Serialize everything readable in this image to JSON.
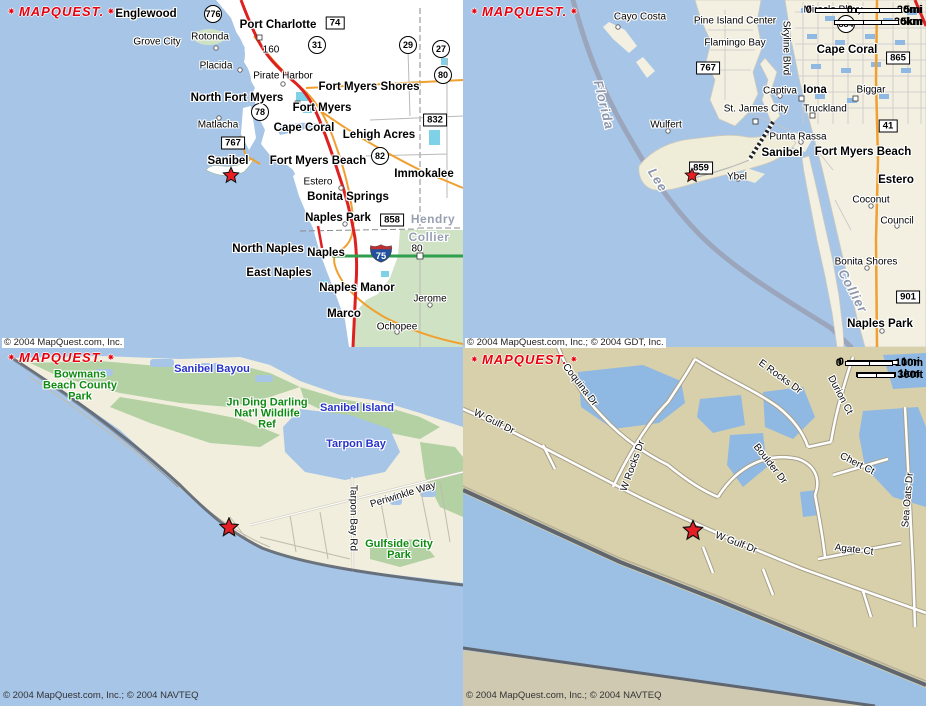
{
  "logo": {
    "text": "MAPQUEST."
  },
  "copyrights": {
    "mid_left": "© 2004 MapQuest.com, Inc.",
    "mid_right": "© 2004 MapQuest.com, Inc.; © 2004 GDT, Inc.",
    "bottom_left": "© 2004 MapQuest.com, Inc.; © 2004 NAVTEQ",
    "bottom_right": "© 2004 MapQuest.com, Inc.; © 2004 NAVTEQ"
  },
  "colors": {
    "water": "#a7c5e7",
    "land_white": "#ffffff",
    "land_cream": "#f3f0e2",
    "land_pale": "#f1eedd",
    "land_tan": "#d7d0ab",
    "land_tan_muted": "#cfc9b2",
    "park_green": "#b3d1a2",
    "park_light": "#cfe2c4",
    "lake_cyan": "#7fd1e8",
    "canal_blue": "#8fb8e2",
    "road_red": "#dd2020",
    "road_orange": "#f0a030",
    "road_green": "#2f9e4f",
    "road_gray": "#b9b9b9",
    "boundary_gray": "#99a0b4",
    "shore_dark": "#5f6670",
    "star_red": "#e81e25",
    "logo_red": "#e8000c",
    "label_water_blue": "#2733cc",
    "label_park_green": "#0e8a10",
    "label_county_gray": "#98a0b0"
  },
  "maps": [
    {
      "name": "regional-overview",
      "scale": {
        "zero": "0",
        "primary": "20mi",
        "secondary": "20km"
      },
      "labels": [
        {
          "type": "city",
          "text": "Englewood",
          "x": 146,
          "y": 14
        },
        {
          "type": "city",
          "text": "Port Charlotte",
          "x": 278,
          "y": 25
        },
        {
          "type": "city",
          "text": "Fort Myers Shores",
          "x": 369,
          "y": 87
        },
        {
          "type": "city",
          "text": "North Fort Myers",
          "x": 237,
          "y": 98
        },
        {
          "type": "city",
          "text": "Fort Myers",
          "x": 322,
          "y": 108
        },
        {
          "type": "city",
          "text": "Cape Coral",
          "x": 304,
          "y": 128
        },
        {
          "type": "city",
          "text": "Lehigh Acres",
          "x": 379,
          "y": 135
        },
        {
          "type": "city",
          "text": "Sanibel",
          "x": 228,
          "y": 161
        },
        {
          "type": "city",
          "text": "Fort Myers Beach",
          "x": 318,
          "y": 161
        },
        {
          "type": "city",
          "text": "Immokalee",
          "x": 424,
          "y": 174
        },
        {
          "type": "city",
          "text": "Bonita Springs",
          "x": 348,
          "y": 197
        },
        {
          "type": "city",
          "text": "Naples Park",
          "x": 338,
          "y": 218
        },
        {
          "type": "city",
          "text": "North Naples",
          "x": 268,
          "y": 249
        },
        {
          "type": "city",
          "text": "Naples",
          "x": 326,
          "y": 253
        },
        {
          "type": "city",
          "text": "East Naples",
          "x": 279,
          "y": 273
        },
        {
          "type": "city",
          "text": "Naples Manor",
          "x": 357,
          "y": 288
        },
        {
          "type": "city",
          "text": "Marco",
          "x": 344,
          "y": 314
        },
        {
          "type": "town",
          "text": "Grove City",
          "x": 157,
          "y": 42
        },
        {
          "type": "town",
          "text": "Rotonda",
          "x": 210,
          "y": 37
        },
        {
          "type": "town",
          "text": "Placida",
          "x": 216,
          "y": 66
        },
        {
          "type": "town",
          "text": "Pirate Harbor",
          "x": 283,
          "y": 76
        },
        {
          "type": "town",
          "text": "Matlacha",
          "x": 218,
          "y": 125
        },
        {
          "type": "town",
          "text": "Estero",
          "x": 318,
          "y": 182
        },
        {
          "type": "town",
          "text": "Jerome",
          "x": 430,
          "y": 299
        },
        {
          "type": "town",
          "text": "Ochopee",
          "x": 397,
          "y": 327
        },
        {
          "type": "num",
          "text": "160",
          "x": 271,
          "y": 50
        },
        {
          "type": "num",
          "text": "80",
          "x": 417,
          "y": 249
        },
        {
          "type": "county",
          "text": "Hendry",
          "x": 433,
          "y": 219
        },
        {
          "type": "county",
          "text": "Collier",
          "x": 429,
          "y": 237
        }
      ],
      "shields": [
        {
          "shape": "circle",
          "text": "776",
          "x": 213,
          "y": 14
        },
        {
          "shape": "box",
          "text": "74",
          "x": 335,
          "y": 23
        },
        {
          "shape": "circle",
          "text": "31",
          "x": 317,
          "y": 45
        },
        {
          "shape": "circle",
          "text": "29",
          "x": 408,
          "y": 45
        },
        {
          "shape": "circle",
          "text": "27",
          "x": 441,
          "y": 49
        },
        {
          "shape": "circle",
          "text": "80",
          "x": 443,
          "y": 75
        },
        {
          "shape": "circle",
          "text": "78",
          "x": 260,
          "y": 112
        },
        {
          "shape": "box",
          "text": "832",
          "x": 435,
          "y": 120
        },
        {
          "shape": "box",
          "text": "767",
          "x": 233,
          "y": 143
        },
        {
          "shape": "circle",
          "text": "82",
          "x": 380,
          "y": 156
        },
        {
          "shape": "box",
          "text": "858",
          "x": 392,
          "y": 220
        },
        {
          "shape": "interstate",
          "text": "75",
          "x": 381,
          "y": 256
        }
      ],
      "star": {
        "x": 231,
        "y": 175,
        "size": 17
      }
    },
    {
      "name": "islands-area",
      "scale": {
        "zero": "0",
        "primary": "5mi",
        "secondary": "5km"
      },
      "labels": [
        {
          "type": "city",
          "text": "Cape Coral",
          "x": 847,
          "y": 50
        },
        {
          "type": "city",
          "text": "Iona",
          "x": 815,
          "y": 90
        },
        {
          "type": "city",
          "text": "Sanibel",
          "x": 782,
          "y": 153
        },
        {
          "type": "city",
          "text": "Fort Myers Beach",
          "x": 863,
          "y": 152
        },
        {
          "type": "city",
          "text": "Estero",
          "x": 896,
          "y": 180
        },
        {
          "type": "city",
          "text": "Naples Park",
          "x": 880,
          "y": 324
        },
        {
          "type": "town",
          "text": "Cayo Costa",
          "x": 640,
          "y": 17
        },
        {
          "type": "town",
          "text": "Pine Island Center",
          "x": 735,
          "y": 21
        },
        {
          "type": "town",
          "text": "Flamingo Bay",
          "x": 735,
          "y": 43
        },
        {
          "type": "town",
          "text": "Miracle Pkwy",
          "x": 833,
          "y": 10
        },
        {
          "type": "town",
          "text": "Captiva",
          "x": 780,
          "y": 91
        },
        {
          "type": "town",
          "text": "Wulfert",
          "x": 666,
          "y": 125
        },
        {
          "type": "town",
          "text": "St. James City",
          "x": 756,
          "y": 109
        },
        {
          "type": "town",
          "text": "Truckland",
          "x": 825,
          "y": 109
        },
        {
          "type": "town",
          "text": "Biggar",
          "x": 871,
          "y": 90
        },
        {
          "type": "town",
          "text": "Punta Rassa",
          "x": 798,
          "y": 137
        },
        {
          "type": "town",
          "text": "Ybel",
          "x": 737,
          "y": 177
        },
        {
          "type": "town",
          "text": "Coconut",
          "x": 871,
          "y": 200
        },
        {
          "type": "town",
          "text": "Council",
          "x": 897,
          "y": 221
        },
        {
          "type": "town",
          "text": "Bonita Shores",
          "x": 866,
          "y": 262
        },
        {
          "type": "state",
          "text": "Florida",
          "x": 604,
          "y": 105,
          "rot": 76
        },
        {
          "type": "state",
          "text": "Lee",
          "x": 658,
          "y": 180,
          "rot": 58
        },
        {
          "type": "state",
          "text": "Collier",
          "x": 853,
          "y": 291,
          "rot": 62
        },
        {
          "type": "street",
          "text": "Skyline Blvd",
          "x": 786,
          "y": 48,
          "rot": 90
        }
      ],
      "shields": [
        {
          "shape": "box",
          "text": "767",
          "x": 708,
          "y": 68
        },
        {
          "shape": "circle",
          "text": "884",
          "x": 846,
          "y": 24
        },
        {
          "shape": "box",
          "text": "865",
          "x": 898,
          "y": 58
        },
        {
          "shape": "box",
          "text": "41",
          "x": 888,
          "y": 126
        },
        {
          "shape": "box",
          "text": "859",
          "x": 701,
          "y": 168
        },
        {
          "shape": "box",
          "text": "901",
          "x": 908,
          "y": 297
        }
      ],
      "star": {
        "x": 692,
        "y": 175,
        "size": 15
      }
    },
    {
      "name": "sanibel-island",
      "scale": {
        "zero": "0",
        "primary": "1mi",
        "secondary": "1km"
      },
      "labels": [
        {
          "type": "water",
          "text": "Sanibel Bayou",
          "x": 212,
          "y": 369
        },
        {
          "type": "water",
          "text": "Sanibel Island",
          "x": 357,
          "y": 408
        },
        {
          "type": "water",
          "text": "Tarpon Bay",
          "x": 356,
          "y": 444
        },
        {
          "type": "park",
          "text": "Bowmans\nBeach County\nPark",
          "x": 80,
          "y": 386
        },
        {
          "type": "park",
          "text": "Jn Ding Darling\nNat'l Wildlife\nRef",
          "x": 267,
          "y": 414
        },
        {
          "type": "park",
          "text": "Gulfside City\nPark",
          "x": 399,
          "y": 550
        },
        {
          "type": "street",
          "text": "Periwinkle Way",
          "x": 403,
          "y": 495,
          "rot": -17
        },
        {
          "type": "street",
          "text": "Tarpon Bay Rd",
          "x": 353,
          "y": 518,
          "rot": 90
        }
      ],
      "shields": [],
      "star": {
        "x": 229,
        "y": 527,
        "size": 20
      }
    },
    {
      "name": "w-gulf-dr-streets",
      "scale": {
        "zero": "0",
        "primary": "100m",
        "secondary": "300ft"
      },
      "labels": [
        {
          "type": "street",
          "text": "Coquina Dr",
          "x": 580,
          "y": 385,
          "rot": 52
        },
        {
          "type": "street",
          "text": "W Gulf Dr",
          "x": 494,
          "y": 422,
          "rot": 26
        },
        {
          "type": "street",
          "text": "W Rocks Dr",
          "x": 633,
          "y": 466,
          "rot": -70
        },
        {
          "type": "street",
          "text": "E Rocks Dr",
          "x": 780,
          "y": 377,
          "rot": 36
        },
        {
          "type": "street",
          "text": "Durion Ct",
          "x": 840,
          "y": 395,
          "rot": 62
        },
        {
          "type": "street",
          "text": "Boulder Dr",
          "x": 770,
          "y": 464,
          "rot": 52
        },
        {
          "type": "street",
          "text": "Chert Ct",
          "x": 857,
          "y": 464,
          "rot": 27
        },
        {
          "type": "street",
          "text": "Sea Oats Dr",
          "x": 908,
          "y": 500,
          "rot": -85
        },
        {
          "type": "street",
          "text": "W Gulf Dr",
          "x": 736,
          "y": 543,
          "rot": 21
        },
        {
          "type": "street",
          "text": "Agate Ct",
          "x": 854,
          "y": 550,
          "rot": 7
        }
      ],
      "shields": [],
      "star": {
        "x": 693,
        "y": 530,
        "size": 21
      }
    }
  ]
}
